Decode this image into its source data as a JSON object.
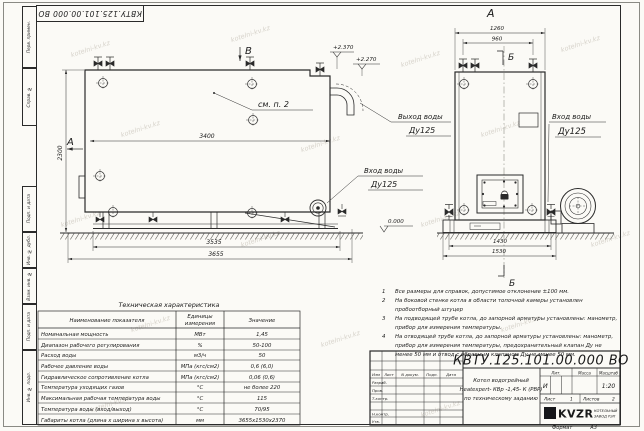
{
  "sheet": {
    "stamp_top": "КВТУ.125.101.00.000 ВО",
    "format_label": "Формат",
    "format_value": "А3",
    "watermark": "kotelni-kv.kz",
    "ink": "#2a2a2a"
  },
  "margin": {
    "top_labels": [
      "Перв. примен.",
      "Справ. №"
    ],
    "bottom_labels": [
      "Подп. и дата",
      "Инв. № дубл.",
      "Взам. инв. №",
      "Подп. и дата",
      "Инв. № подл."
    ]
  },
  "side_view": {
    "view_arrow": "В",
    "section_label": "А",
    "see_note": "см. п. 2",
    "elev_top1": "+2.370",
    "elev_top2": "+2.270",
    "elev_zero": "0.000",
    "dim_width_inner": "3400",
    "dim_height": "2300",
    "dim_base": "3535",
    "dim_total": "3655",
    "outlet_label": "Выход воды",
    "outlet_dn": "Ду125",
    "inlet_label": "Вход воды",
    "inlet_dn": "Ду125"
  },
  "front_view": {
    "view_label": "А",
    "dim_top": "1260",
    "dim_valves": "960",
    "section_top": "Б",
    "section_bottom": "Б",
    "dim_base": "1430",
    "dim_total": "1530",
    "inlet_label": "Вход воды",
    "inlet_dn": "Ду125"
  },
  "notes": [
    {
      "num": "1",
      "text": "Все размеры для справок, допустимое отклонение ±100 мм."
    },
    {
      "num": "2",
      "text": "На боковой стенке котла в области топочной камеры установлен пробоотборный штуцер"
    },
    {
      "num": "3",
      "text": "На подводящей трубе котла, до запорной арматуры установлены: манометр, прибор для измерения температуры."
    },
    {
      "num": "4",
      "text": "На отводящей трубе котла, до запорной арматуры установлены: манометр, прибор для измерения температуры, предохранительный клапан Ду не менее 50 мм и отвод с обратным клапаном Ду не менее 50 мм."
    }
  ],
  "spec_table": {
    "title": "Техническая характеристика",
    "headers": {
      "name": "Наименование показателя",
      "units": [
        "Единицы",
        "измерения"
      ],
      "value": "Значение"
    },
    "rows": [
      [
        "Номинальная мощность",
        "МВт",
        "1,45"
      ],
      [
        "Диапазон рабочего регулирования",
        "%",
        "50-100"
      ],
      [
        "Расход воды",
        "м3/ч",
        "50"
      ],
      [
        "Рабочее давление воды",
        "МПа (кгс/см2)",
        "0,6 (6,0)"
      ],
      [
        "Гидравлическое сопротивление котла",
        "МПа (кгс/см2)",
        "0,06 (0,6)"
      ],
      [
        "Температура уходящих газов",
        "°С",
        "не более 220"
      ],
      [
        "Максимальная рабочая температура воды",
        "°С",
        "115"
      ],
      [
        "Температура воды (вход/выход)",
        "°С",
        "70/95"
      ],
      [
        "Габариты котла (длина х ширина х высота)",
        "мм",
        "3655х1530х2370"
      ]
    ]
  },
  "title_block": {
    "designation": "КВТУ.125.101.00.000  ВО",
    "name_line1": "Котел водогрейный",
    "name_line2": "Heatexpert- КВр -1,45- К (РВР)",
    "name_line3": "по техническому заданию",
    "header_cols": [
      "Изм",
      "Лист",
      "N докум.",
      "Подп.",
      "Дата"
    ],
    "sig_rows": [
      "Разраб.",
      "Пров.",
      "Т.контр.",
      "",
      "Н.контр.",
      "Утв."
    ],
    "lit_header": "Лит.",
    "lit_value": "И",
    "mass_header": "Масса",
    "scale_header": "Масштаб",
    "scale_value": "1:20",
    "sheet_label": "Лист",
    "sheet_value": "1",
    "sheets_label": "Листов",
    "sheets_value": "2",
    "logo": "KVZR",
    "logo_caption1": "КОТЕЛЬНЫЙ",
    "logo_caption2": "ЗАВОД РЭП"
  }
}
